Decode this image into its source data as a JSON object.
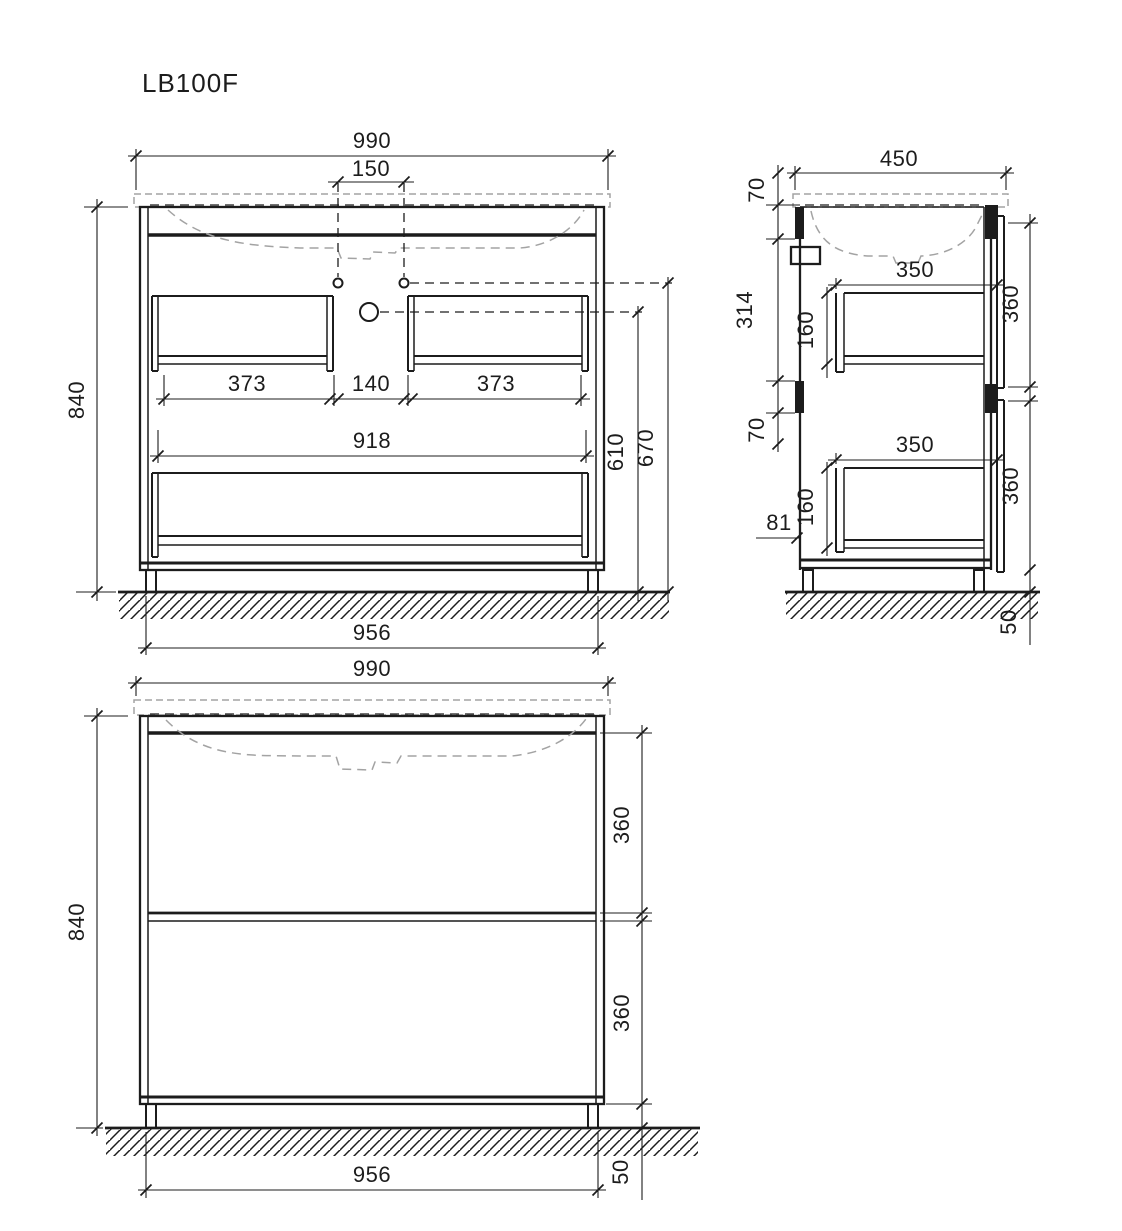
{
  "title": "LB100F",
  "front_open": {
    "width": "990",
    "faucet_spacing": "150",
    "height": "840",
    "drawer_left": "373",
    "drawer_gap": "140",
    "drawer_right": "373",
    "drawer_wide": "918",
    "drain_height": "610",
    "faucet_height": "670",
    "base_width": "956"
  },
  "side": {
    "depth": "450",
    "top_offset": "70",
    "upper_span": "314",
    "mid_offset": "70",
    "drawer_depth_top": "350",
    "drawer_height_top": "160",
    "front_top": "360",
    "drawer_depth_bottom": "350",
    "drawer_height_bottom": "160",
    "bottom_gap": "81",
    "front_bottom": "360",
    "leg_height": "50"
  },
  "front_closed": {
    "width": "990",
    "height": "840",
    "front_top": "360",
    "front_bottom": "360",
    "base_width": "956",
    "leg_height": "50"
  }
}
